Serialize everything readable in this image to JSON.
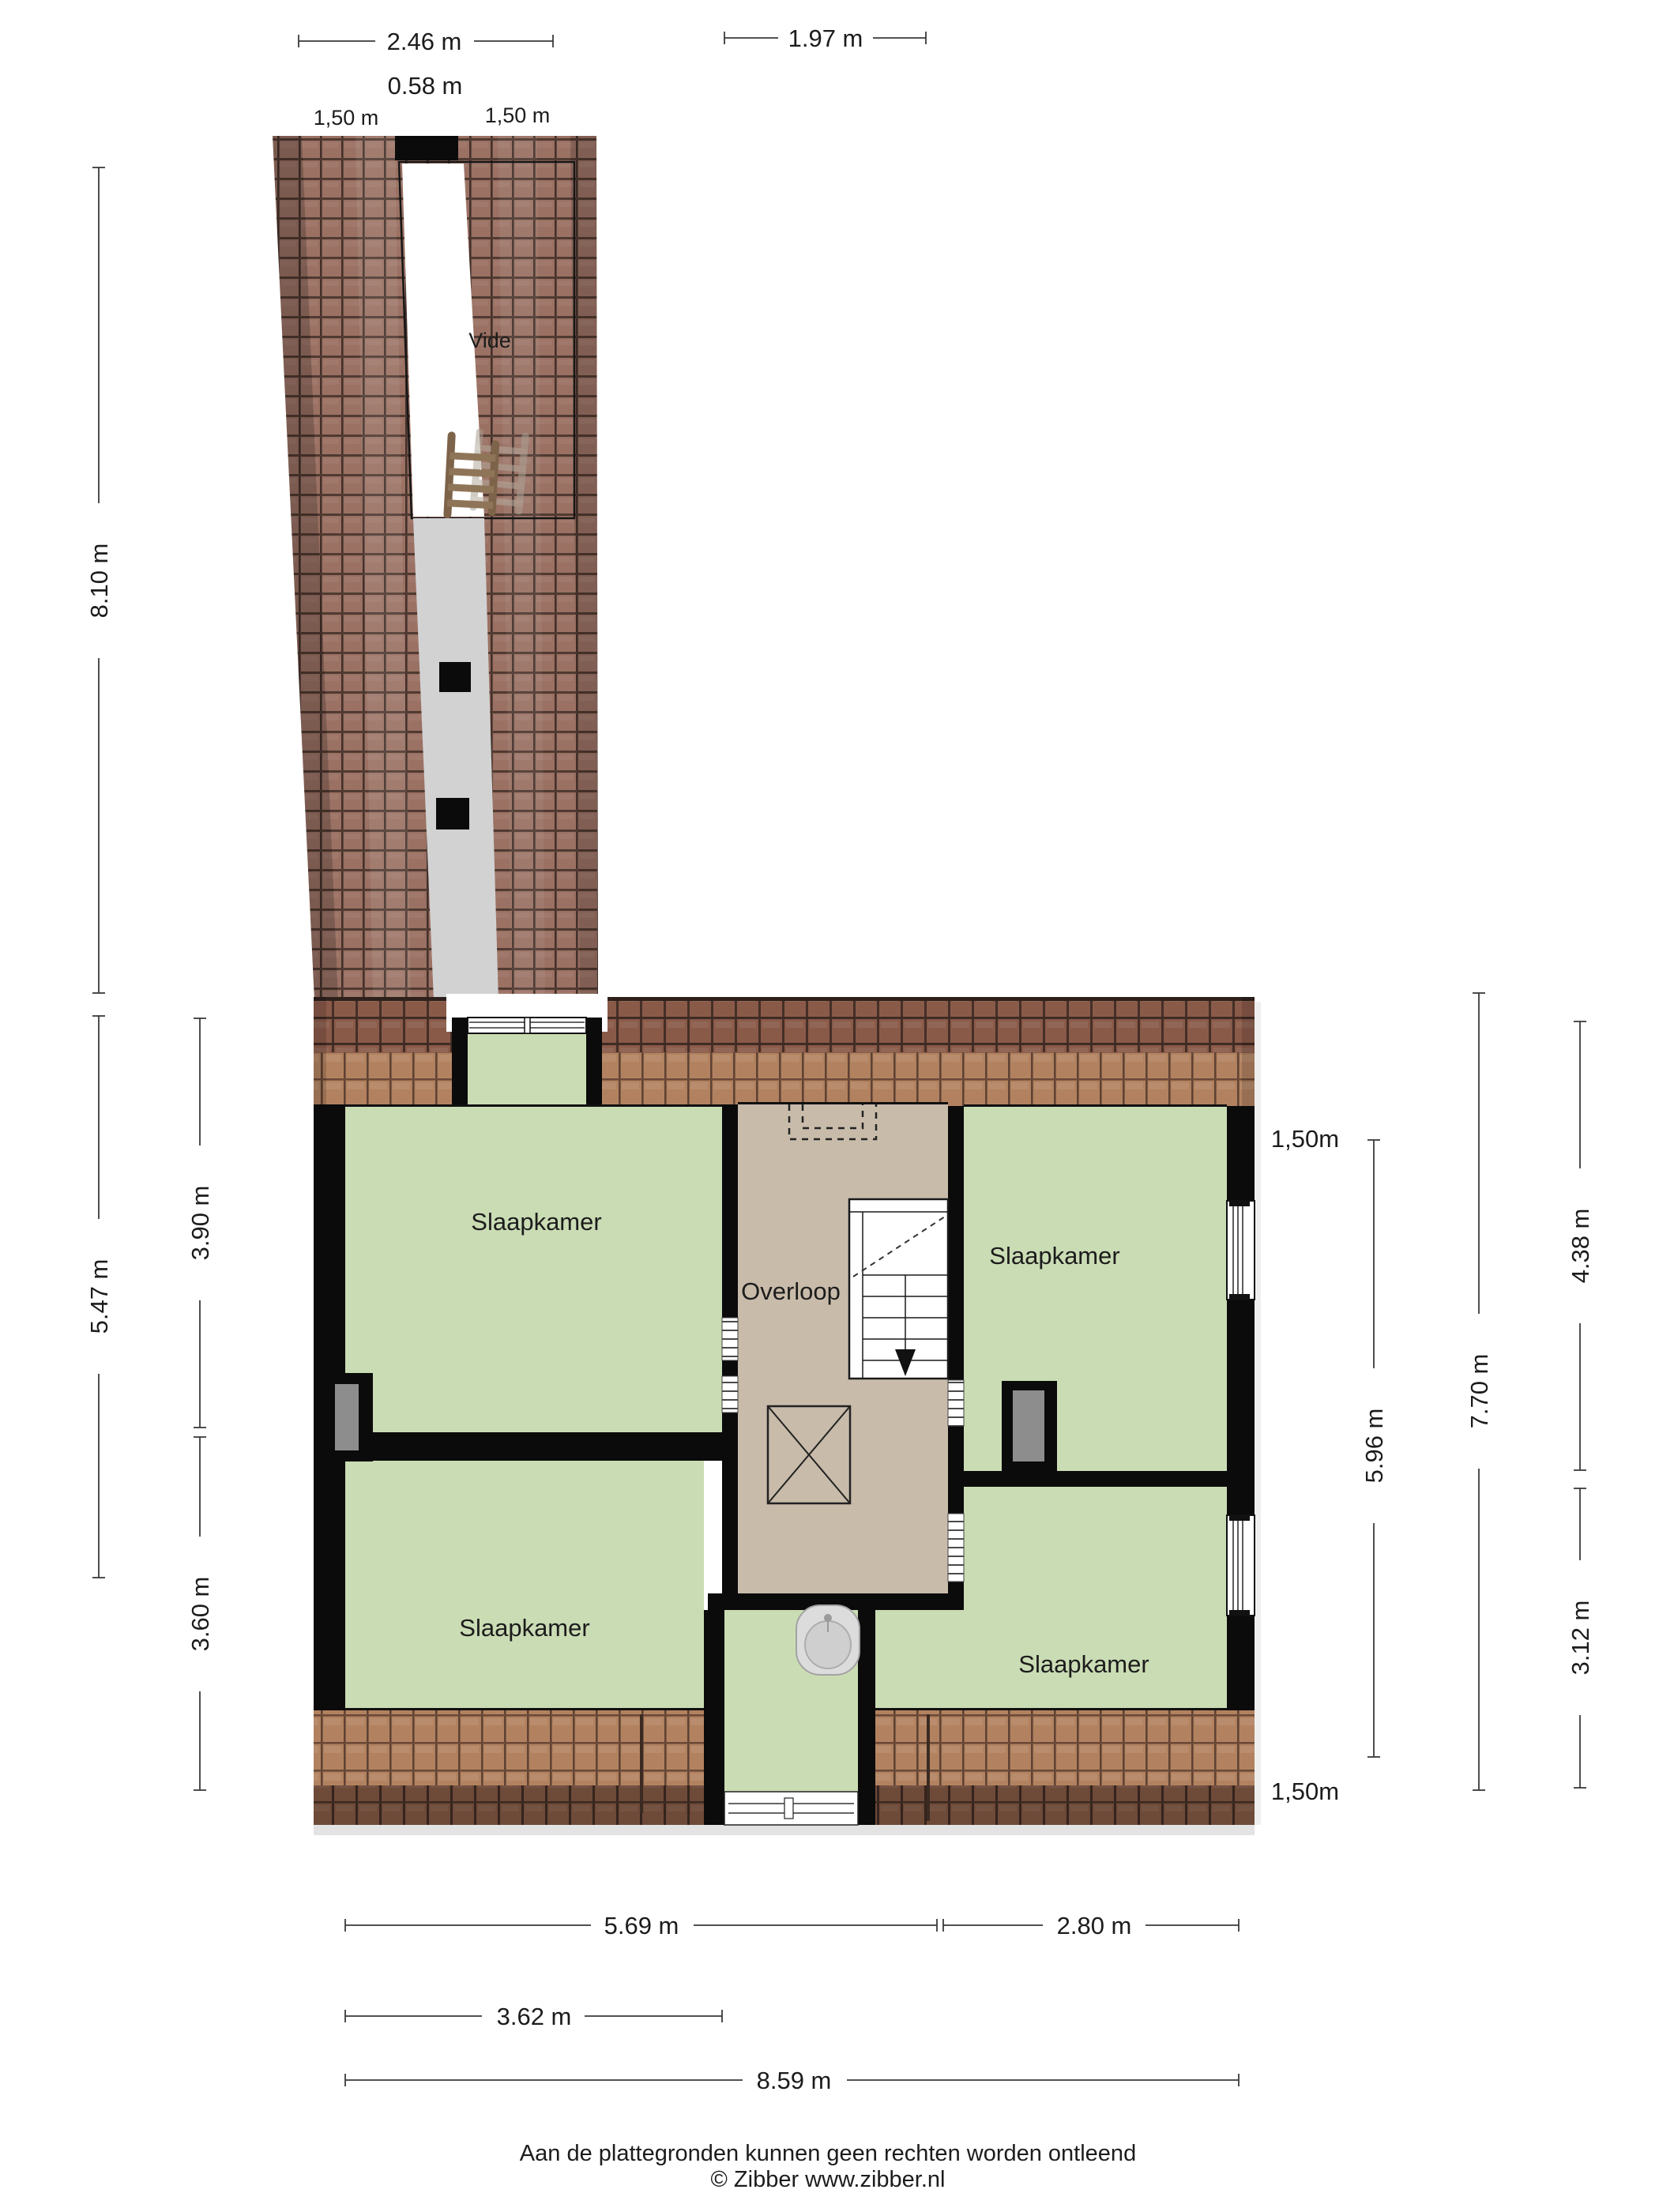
{
  "plan": {
    "rooms": [
      {
        "id": "vide",
        "label": "Vide"
      },
      {
        "id": "overloop",
        "label": "Overloop"
      },
      {
        "id": "bedroom-top-left",
        "label": "Slaapkamer"
      },
      {
        "id": "bedroom-top-right",
        "label": "Slaapkamer"
      },
      {
        "id": "bedroom-bottom-left",
        "label": "Slaapkamer"
      },
      {
        "id": "bedroom-bottom-right",
        "label": "Slaapkamer"
      }
    ]
  },
  "dimensions": {
    "top": [
      {
        "label": "2.46 m"
      },
      {
        "label": "1.97 m"
      },
      {
        "label": "0.58 m"
      },
      {
        "label": "1,50 m"
      },
      {
        "label": "1,50 m"
      }
    ],
    "left": [
      {
        "label": "8.10 m"
      },
      {
        "label": "5.47 m"
      },
      {
        "label": "3.90 m"
      },
      {
        "label": "3.60 m"
      }
    ],
    "right": [
      {
        "label": "1,50m"
      },
      {
        "label": "5.96 m"
      },
      {
        "label": "7.70 m"
      },
      {
        "label": "4.38 m"
      },
      {
        "label": "3.12 m"
      },
      {
        "label": "1,50m"
      }
    ],
    "bottom": [
      {
        "label": "5.69 m"
      },
      {
        "label": "2.80 m"
      },
      {
        "label": "3.62 m"
      },
      {
        "label": "8.59 m"
      }
    ]
  },
  "footer": {
    "disclaimer": "Aan de plattegronden kunnen geen rechten worden ontleend",
    "credit": "© Zibber www.zibber.nl"
  },
  "colors": {
    "wall_black": "#0b0b0b",
    "room_green": "#cadcb4",
    "overloop_tan": "#c8bbaa",
    "corridor_gray": "#d2d2d2",
    "niche_gray": "#8d8d8d",
    "dim_line": "#3a3a3a",
    "tile_tower": "#9a7163",
    "tile_ridge": "#8a5a49",
    "tile_light": "#b28260",
    "tile_eave": "#6e4a39"
  }
}
